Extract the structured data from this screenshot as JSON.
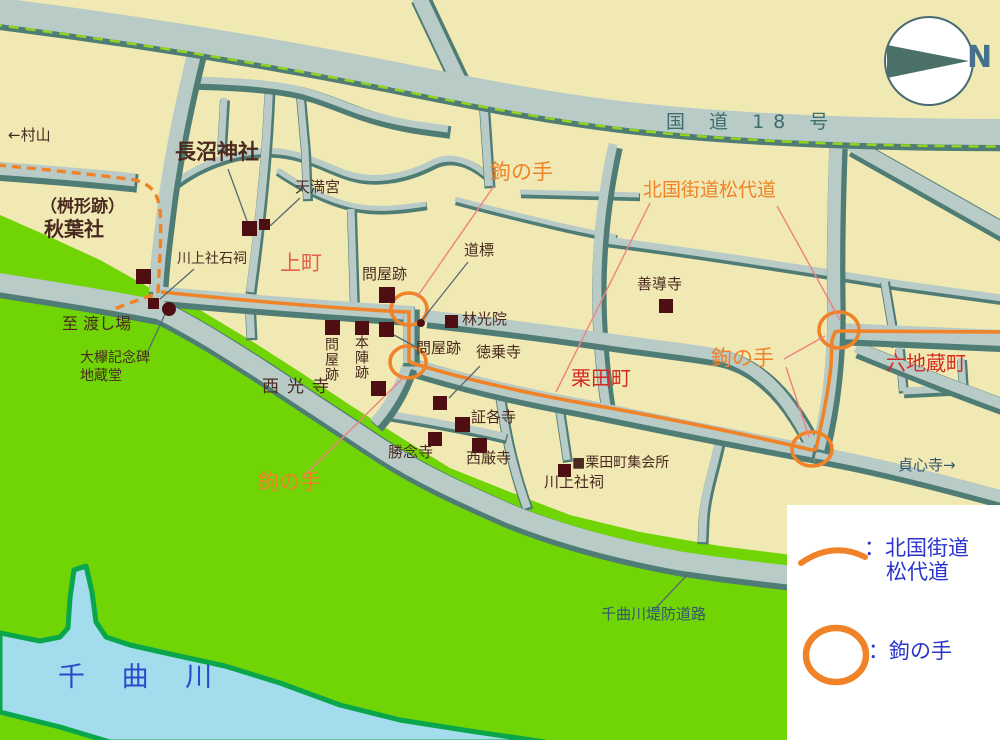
{
  "palette": {
    "land": "#f0e9b3",
    "bank_green": "#70d405",
    "river_fill": "#a3dced",
    "river_edge": "#0aa64c",
    "road_fill": "#b9cbc7",
    "road_edge": "#4f7d75",
    "route_orange": "#f08228",
    "marker_maroon": "#4e0e12",
    "label_dark_brown": "#4a2a20",
    "label_red": "#d42a20",
    "label_coral_red": "#e4604e",
    "label_slate_teal": "#3f6d6d",
    "label_slate_blue": "#33566e",
    "legend_blue": "#2b35cc",
    "river_text_blue": "#2b49c8",
    "leader_pink": "#f08080"
  },
  "compass": {
    "n": "N"
  },
  "legend": {
    "route_label_line1": "：北国街道",
    "route_label_line2": "松代道",
    "kaginote_label": "：鉤の手"
  },
  "map": {
    "labels": [
      {
        "name": "direction-murayama-label",
        "text": "←村山",
        "x": 8,
        "y": 128,
        "fs": 15,
        "cls": "c-dark"
      },
      {
        "name": "naganuma-shrine-label",
        "text": "長沼神社",
        "x": 175,
        "y": 142,
        "fs": 21,
        "cls": "c-dark",
        "bold": true
      },
      {
        "name": "tenmangu-label",
        "text": "天満宮",
        "x": 295,
        "y": 180,
        "fs": 15,
        "cls": "c-dark"
      },
      {
        "name": "masugata-ato-label",
        "text": "（桝形跡）",
        "x": 40,
        "y": 199,
        "fs": 17,
        "cls": "c-dark",
        "bold": true
      },
      {
        "name": "akiba-shrine-label",
        "text": "秋葉社",
        "x": 44,
        "y": 219,
        "fs": 20,
        "cls": "c-dark",
        "bold": true
      },
      {
        "name": "kawakami-sekishi-label",
        "text": "川上社石祠",
        "x": 177,
        "y": 252,
        "fs": 14,
        "cls": "c-dark"
      },
      {
        "name": "kammachi-label",
        "text": "上町",
        "x": 280,
        "y": 253,
        "fs": 21,
        "cls": "c-coral"
      },
      {
        "name": "toiya-ato-kami-label",
        "text": "問屋跡",
        "x": 362,
        "y": 267,
        "fs": 15,
        "cls": "c-dark"
      },
      {
        "name": "dohyo-label",
        "text": "道標",
        "x": 464,
        "y": 243,
        "fs": 15,
        "cls": "c-dark"
      },
      {
        "name": "watashiba-label",
        "text": "至 渡し場",
        "x": 62,
        "y": 316,
        "fs": 16,
        "cls": "c-dark"
      },
      {
        "name": "okeyaki-kinenhi-label",
        "text": "大欅記念碑",
        "x": 80,
        "y": 351,
        "fs": 14,
        "cls": "c-dark"
      },
      {
        "name": "jizodo-label",
        "text": "地蔵堂",
        "x": 80,
        "y": 369,
        "fs": 14,
        "cls": "c-dark"
      },
      {
        "name": "rinkoin-label",
        "text": "林光院",
        "x": 462,
        "y": 312,
        "fs": 15,
        "cls": "c-dark"
      },
      {
        "name": "toiya-ato-1-label",
        "text": "問屋跡",
        "x": 324,
        "y": 337,
        "fs": 14,
        "cls": "c-dark",
        "vertical": true
      },
      {
        "name": "honjin-ato-label",
        "text": "本陣跡",
        "x": 354,
        "y": 335,
        "fs": 14,
        "cls": "c-dark",
        "vertical": true
      },
      {
        "name": "toiya-ato-2-label",
        "text": "問屋跡",
        "x": 416,
        "y": 341,
        "fs": 15,
        "cls": "c-dark"
      },
      {
        "name": "saikoji-label",
        "text": "西光寺",
        "x": 262,
        "y": 379,
        "fs": 17,
        "cls": "c-dark",
        "ls": 8
      },
      {
        "name": "tokujoji-label",
        "text": "徳乗寺",
        "x": 476,
        "y": 345,
        "fs": 15,
        "cls": "c-dark"
      },
      {
        "name": "shokakuji-label",
        "text": "証各寺",
        "x": 471,
        "y": 410,
        "fs": 15,
        "cls": "c-dark"
      },
      {
        "name": "shonenji-label",
        "text": "勝念寺",
        "x": 388,
        "y": 445,
        "fs": 15,
        "cls": "c-dark"
      },
      {
        "name": "saigonji-label",
        "text": "西厳寺",
        "x": 466,
        "y": 451,
        "fs": 15,
        "cls": "c-dark"
      },
      {
        "name": "zendoji-label",
        "text": "善導寺",
        "x": 637,
        "y": 277,
        "fs": 15,
        "cls": "c-dark"
      },
      {
        "name": "kurita-meeting-hall-label",
        "text": "■栗田町集会所",
        "x": 572,
        "y": 456,
        "fs": 14,
        "cls": "c-dark"
      },
      {
        "name": "kawakami-hokora-label",
        "text": "川上社祠",
        "x": 544,
        "y": 475,
        "fs": 15,
        "cls": "c-dark"
      },
      {
        "name": "kuritamachi-label",
        "text": "栗田町",
        "x": 571,
        "y": 368,
        "fs": 20,
        "cls": "c-red"
      },
      {
        "name": "rokujizomachi-label",
        "text": "六地蔵町",
        "x": 886,
        "y": 353,
        "fs": 20,
        "cls": "c-red"
      },
      {
        "name": "kokudo-18-label",
        "text": "国 道 18 号",
        "x": 666,
        "y": 113,
        "fs": 19,
        "cls": "c-slate",
        "ls": 9
      },
      {
        "name": "teishinji-label",
        "text": "貞心寺→",
        "x": 898,
        "y": 458,
        "fs": 15,
        "cls": "c-sblue"
      },
      {
        "name": "chikumagawa-teibo-label",
        "text": "千曲川堤防道路",
        "x": 601,
        "y": 607,
        "fs": 15,
        "cls": "c-sblue"
      },
      {
        "name": "chikumagawa-label",
        "text": "千 曲 川",
        "x": 58,
        "y": 664,
        "fs": 27,
        "cls": "c-river",
        "ls": 14
      },
      {
        "name": "kaginote-top-label",
        "text": "鉤の手",
        "x": 490,
        "y": 162,
        "fs": 21,
        "cls": "c-orange"
      },
      {
        "name": "kaginote-right-label",
        "text": "鉤の手",
        "x": 711,
        "y": 348,
        "fs": 21,
        "cls": "c-orange"
      },
      {
        "name": "kaginote-southwest-label",
        "text": "鉤の手",
        "x": 258,
        "y": 472,
        "fs": 21,
        "cls": "c-orange"
      },
      {
        "name": "hokkoku-kaido-label",
        "text": "北国街道松代道",
        "x": 643,
        "y": 181,
        "fs": 19,
        "cls": "c-orange"
      }
    ],
    "markers": {
      "squares": [
        {
          "name": "naganuma-shrine-marker",
          "x": 242,
          "y": 221,
          "s": 15
        },
        {
          "name": "tenmangu-marker",
          "x": 259,
          "y": 219,
          "s": 11
        },
        {
          "name": "akiba-shrine-marker",
          "x": 136,
          "y": 269,
          "s": 15
        },
        {
          "name": "kawakami-sekishi-marker",
          "x": 148,
          "y": 298,
          "s": 11
        },
        {
          "name": "toiya-ato-kami-marker",
          "x": 379,
          "y": 287,
          "s": 16
        },
        {
          "name": "rinkoin-marker",
          "x": 445,
          "y": 315,
          "s": 13
        },
        {
          "name": "toiya-ato-1-marker",
          "x": 325,
          "y": 320,
          "s": 15
        },
        {
          "name": "honjin-ato-marker",
          "x": 355,
          "y": 321,
          "s": 14
        },
        {
          "name": "toiya-ato-2-marker",
          "x": 379,
          "y": 322,
          "s": 15
        },
        {
          "name": "saikoji-marker",
          "x": 371,
          "y": 381,
          "s": 15
        },
        {
          "name": "tokujoji-marker",
          "x": 433,
          "y": 396,
          "s": 14
        },
        {
          "name": "shokakuji-marker",
          "x": 455,
          "y": 417,
          "s": 15
        },
        {
          "name": "shonenji-marker",
          "x": 428,
          "y": 432,
          "s": 14
        },
        {
          "name": "saigonji-marker",
          "x": 472,
          "y": 438,
          "s": 15
        },
        {
          "name": "zendoji-marker",
          "x": 659,
          "y": 299,
          "s": 14
        },
        {
          "name": "kurita-meeting-hall-marker",
          "x": 558,
          "y": 464,
          "s": 13
        }
      ],
      "dots": [
        {
          "name": "okeyaki-kinenhi-marker",
          "cx": 169,
          "cy": 309,
          "r": 7
        },
        {
          "name": "dohyo-stone-marker",
          "cx": 421,
          "cy": 323,
          "r": 4
        }
      ]
    }
  }
}
